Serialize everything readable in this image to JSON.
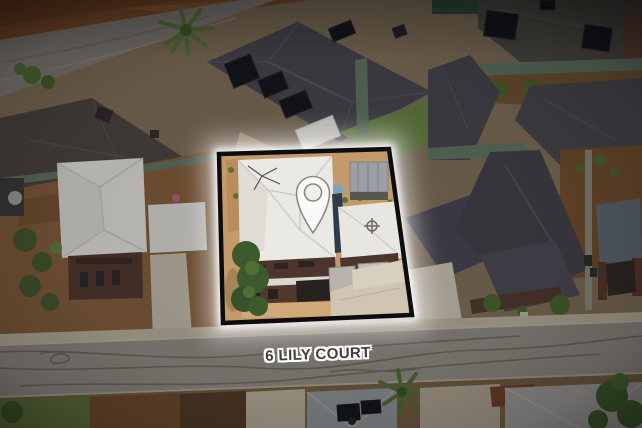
{
  "photo": {
    "type": "aerial-property-photo",
    "address_label": "6 LILY COURT",
    "overlay": {
      "pin_icon": "location-pin-icon",
      "boundary": "property-boundary-highlight"
    },
    "colors": {
      "boundary_stroke": "#0d0d0d",
      "glow": "#ffffff",
      "label_text": "#3f3e3c",
      "label_outline": "#ffffff",
      "pin_fill": "#fbfaf8",
      "pin_stroke": "#8c8a85",
      "road": "#8a857e",
      "dirt_strip": "#7a4a2b",
      "roof_dark": "#46454c",
      "roof_white": "#ebe9e4",
      "grass": "#5d6e3a",
      "solar_panel": "#14171c",
      "fence_green": "#5d6f5e",
      "lot_ground": "#c49a6a"
    }
  }
}
